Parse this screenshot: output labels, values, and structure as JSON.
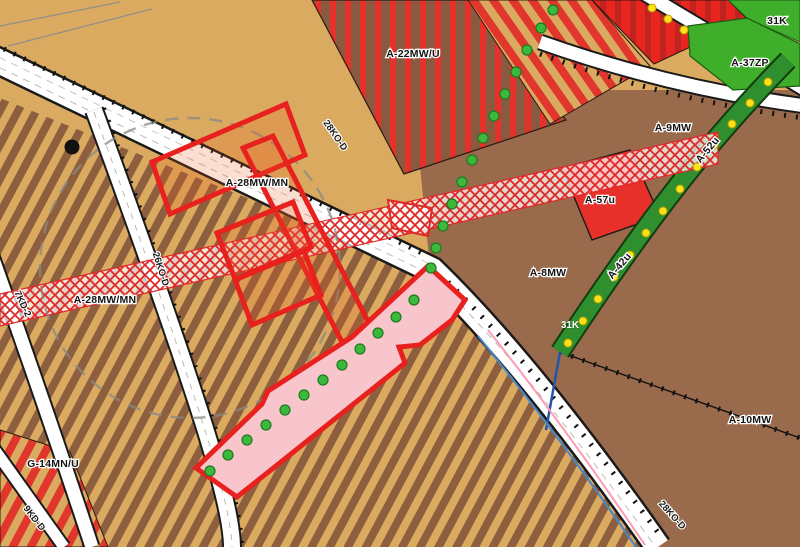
{
  "map": {
    "type": "zoning-cadastral-map",
    "palette": {
      "tan": "#d9aa60",
      "stripe_brown": "#8d5f3e",
      "solid_brown": "#9a6a4c",
      "red": "#e8302a",
      "dark_red_stripe": "#bf2420",
      "pink_highlight": "#f7c5cb",
      "highlight_outline": "#e8201e",
      "bright_green": "#3fae2a",
      "dark_green_strip": "#2f8f2f",
      "tree_green": "#3cb83c",
      "tree_yellow": "#ffe01a",
      "road_white": "#ffffff",
      "hatch_red": "#e02828"
    },
    "labels": {
      "a22": {
        "text": "A-22MW/U"
      },
      "k31ne": {
        "text": "31K"
      },
      "a37": {
        "text": "A-37ZP"
      },
      "a9": {
        "text": "A-9MW"
      },
      "a52": {
        "text": "A-52u"
      },
      "a57": {
        "text": "A-57u"
      },
      "a8": {
        "text": "A-8MW"
      },
      "a42": {
        "text": "A-42u"
      },
      "k31s": {
        "text": "31K"
      },
      "a10": {
        "text": "A-10MW"
      },
      "a28a": {
        "text": "A-28MW/MN"
      },
      "a28b": {
        "text": "A-28MW/MN"
      },
      "g14": {
        "text": "G-14MN/U"
      },
      "r28a": {
        "text": "28KO-D"
      },
      "r26": {
        "text": "26KO-D"
      },
      "r7": {
        "text": "7KD-2"
      },
      "r9": {
        "text": "9KD-D"
      },
      "r28b": {
        "text": "28KO-D"
      }
    }
  }
}
